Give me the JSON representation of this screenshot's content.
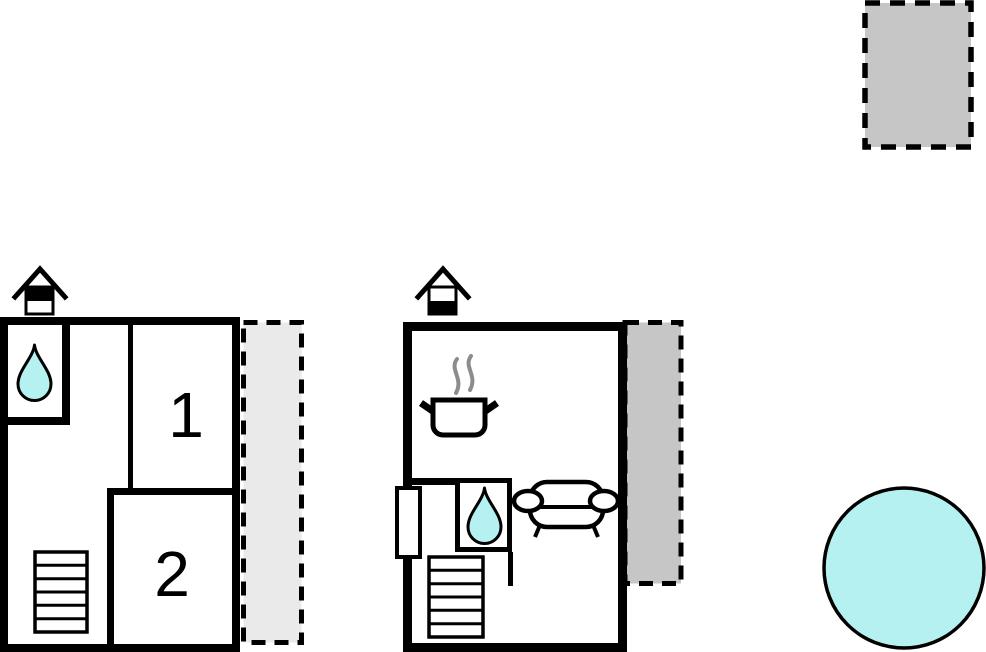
{
  "colors": {
    "wall": "#000000",
    "water": "#b5f1f1",
    "pool": "#b5f1f1",
    "patio_light": "#eaeaea",
    "patio_dark": "#c6c6c6",
    "steam": "#8c8c8c",
    "background": "#ffffff"
  },
  "floor_a": {
    "rooms": [
      {
        "label": "1"
      },
      {
        "label": "2"
      }
    ],
    "features": {
      "fireplace": "fireplace-icon",
      "bathroom": "water-drop-icon",
      "stairs_steps": 6,
      "terrace": "dashed light grey strip"
    }
  },
  "floor_b": {
    "features": {
      "fireplace": "fireplace-icon",
      "kitchen": "cooking-pot-icon",
      "bathroom": "water-drop-icon",
      "living": "sofa-icon",
      "door": "wall opening",
      "stairs_steps": 6,
      "terrace": "dashed grey strip"
    }
  },
  "outdoor": {
    "pool": "round pool",
    "patio": "dashed grey rectangle"
  }
}
